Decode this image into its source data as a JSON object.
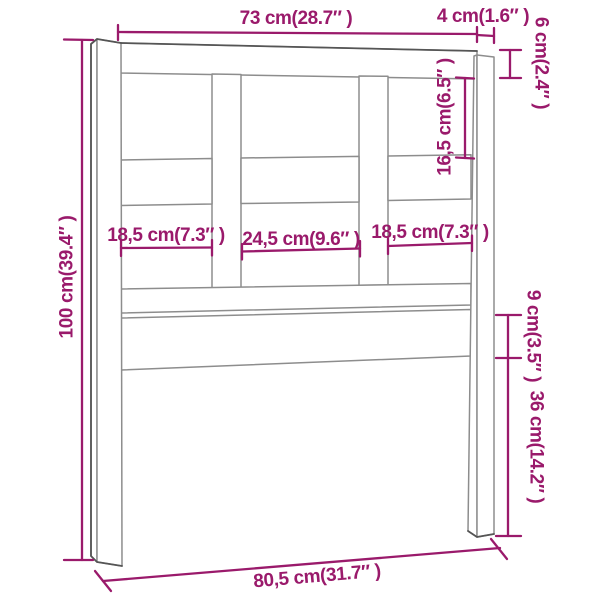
{
  "figure": {
    "kind": "furniture-dimension-diagram",
    "subject": "bed headboard technical drawing"
  },
  "colors": {
    "dimension_annotation": "#9a1a6b",
    "outline_light": "#8d8d8d",
    "outline_dark": "#555555",
    "background": "#ffffff"
  },
  "dimensions": {
    "overall_width_top": "73 cm(28.7″ )",
    "post_width": "4 cm(1.6″ )",
    "top_beam_height": "6 cm(2.4″ )",
    "upper_opening_height": "16,5 cm(6.5″ )",
    "overall_height": "100 cm(39.4″ )",
    "left_opening_width": "18,5 cm(7.3″ )",
    "center_opening_width": "24,5 cm(9.6″ )",
    "right_opening_width": "18,5 cm(7.3″ )",
    "lower_rail_height": "9 cm(3.5″ )",
    "leg_height": "36 cm(14.2″ )",
    "overall_width_bottom": "80,5 cm(31.7″ )"
  }
}
